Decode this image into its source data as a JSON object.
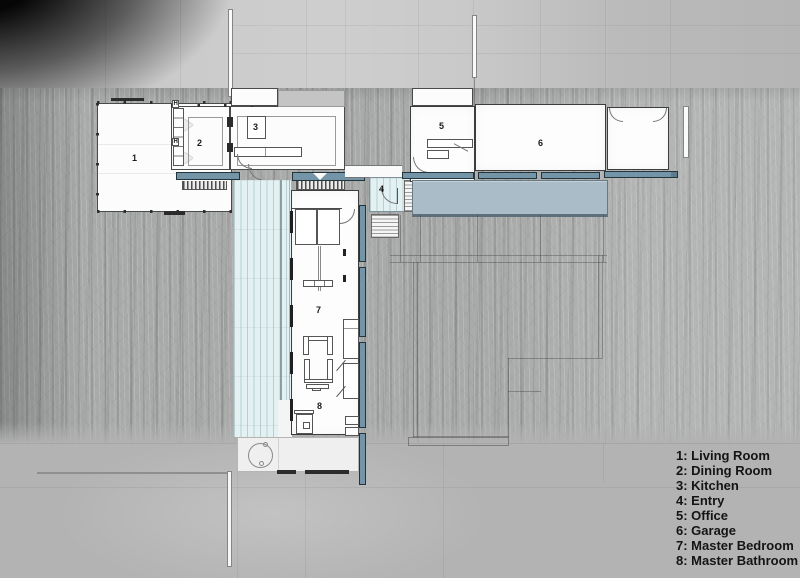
{
  "scene": {
    "title": "Modern house floor plan over forest photograph",
    "type": "architectural-plan-rendering"
  },
  "legend": {
    "items": [
      {
        "num": "1",
        "name": "Living Room",
        "label": "1: Living Room"
      },
      {
        "num": "2",
        "name": "Dining Room",
        "label": "2: Dining Room"
      },
      {
        "num": "3",
        "name": "Kitchen",
        "label": "3: Kitchen"
      },
      {
        "num": "4",
        "name": "Entry",
        "label": "4: Entry"
      },
      {
        "num": "5",
        "name": "Office",
        "label": "5: Office"
      },
      {
        "num": "6",
        "name": "Garage",
        "label": "6: Garage"
      },
      {
        "num": "7",
        "name": "Master Bedroom",
        "label": "7: Master Bedroom"
      },
      {
        "num": "8",
        "name": "Master Bathroom",
        "label": "8: Master Bathroom"
      }
    ]
  },
  "plan": {
    "rooms": [
      {
        "num": "1",
        "name": "Living Room"
      },
      {
        "num": "2",
        "name": "Dining Room"
      },
      {
        "num": "3",
        "name": "Kitchen"
      },
      {
        "num": "4",
        "name": "Entry"
      },
      {
        "num": "5",
        "name": "Office"
      },
      {
        "num": "6",
        "name": "Garage"
      },
      {
        "num": "7",
        "name": "Master Bedroom"
      },
      {
        "num": "8",
        "name": "Master Bathroom"
      }
    ],
    "marks": {
      "h": "H"
    }
  },
  "colors": {
    "deck_teal": "#7495a7",
    "driveway_blue": "#a9bcc8",
    "deck_light_blue": "#e4f1f2",
    "background_gray": "#b2b2b2"
  }
}
